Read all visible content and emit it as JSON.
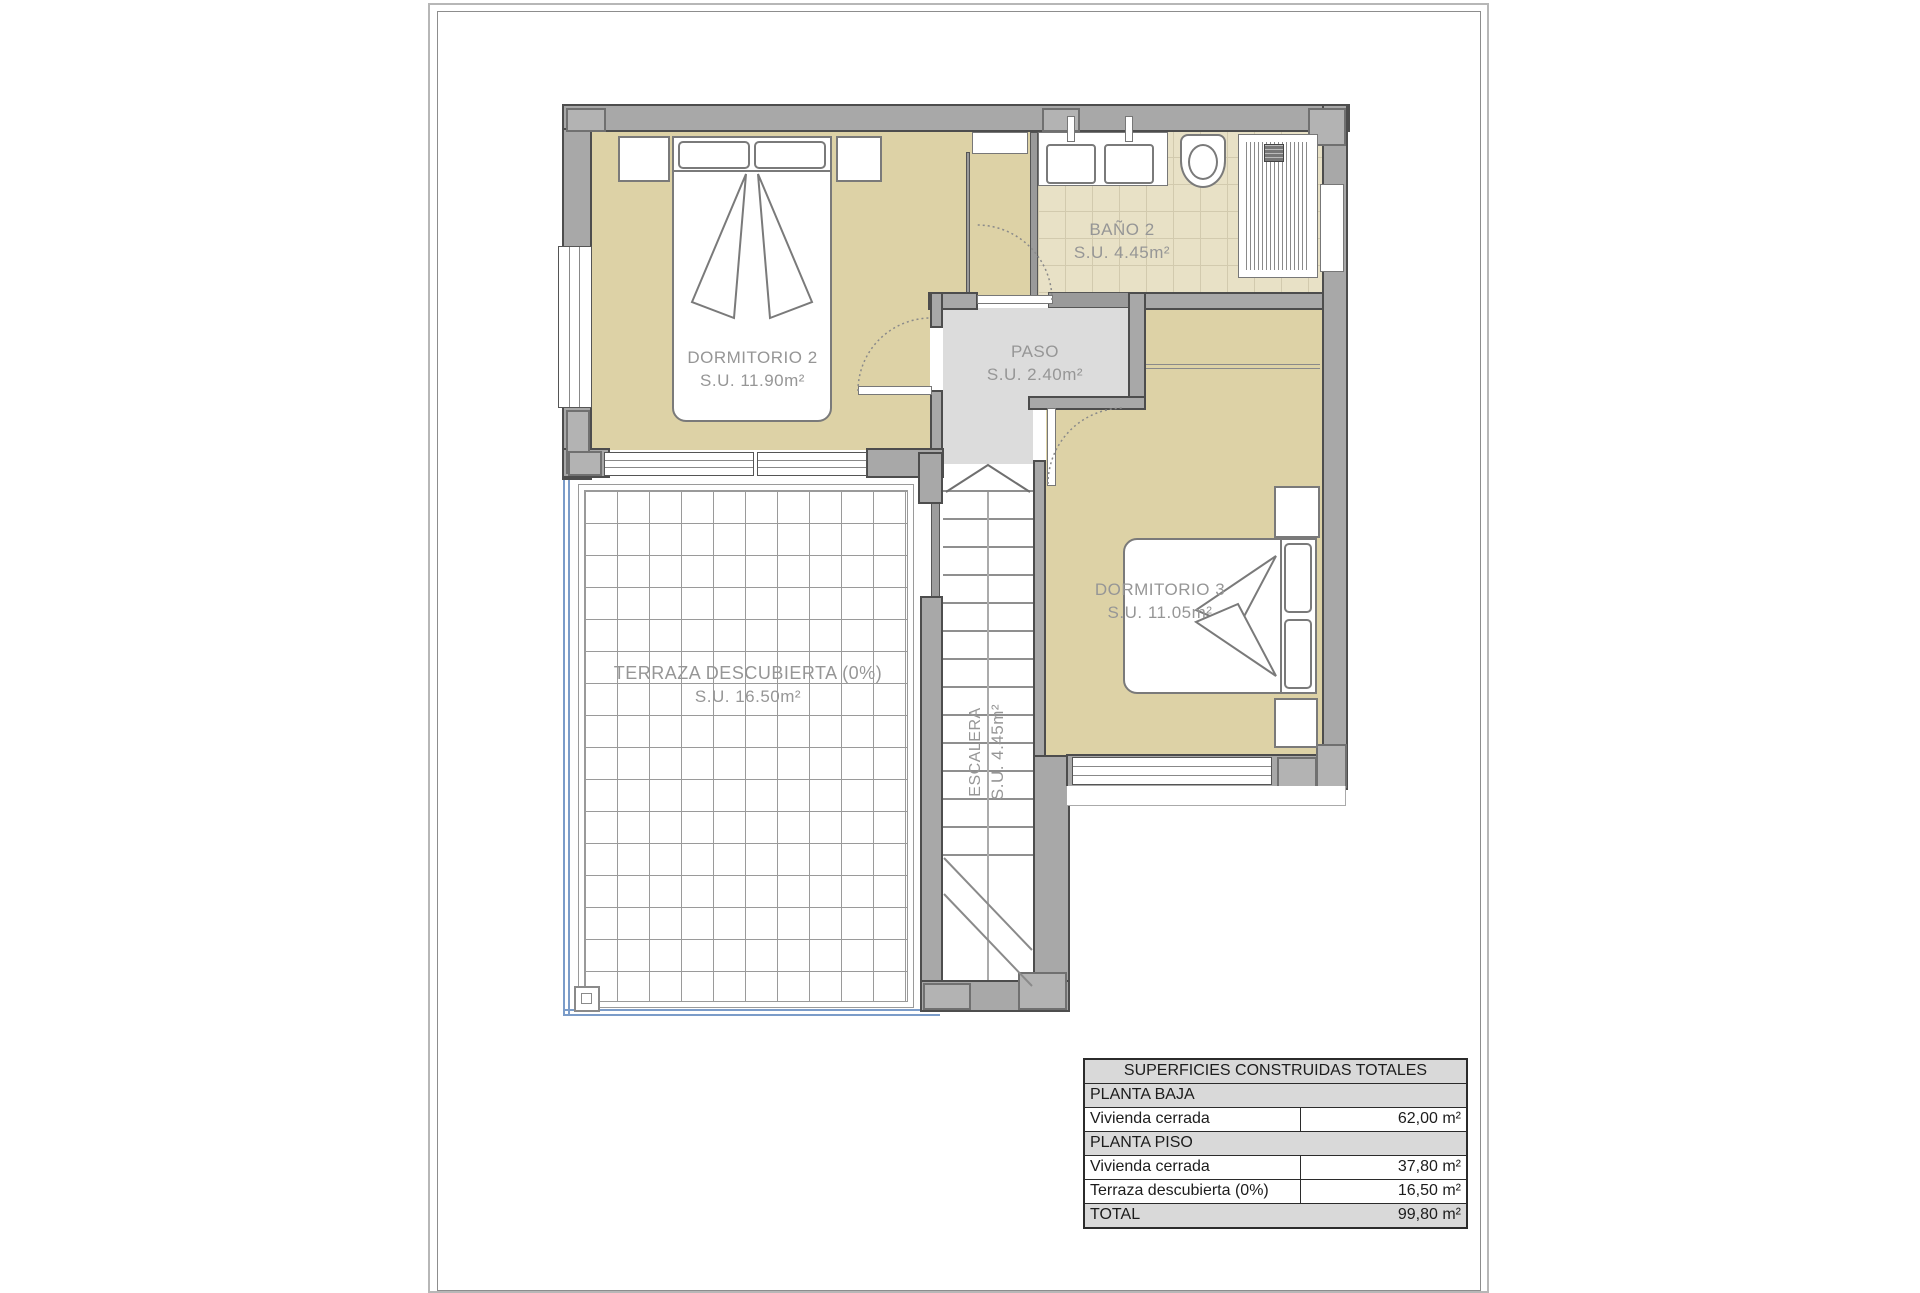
{
  "document": {
    "type": "floor-plan",
    "floor_name": "Planta piso"
  },
  "colors": {
    "room_fill": "#ddd2a6",
    "bath_tile": "#e8e1c6",
    "wall": "#a8a8a8",
    "wall_outline": "#4d4d4d",
    "paso_fill": "#dcdcdc",
    "terrace_rail_blue": "#7b9cc9",
    "label_text": "#969696",
    "table_header_bg": "#d9d9d9"
  },
  "rooms": {
    "dormitorio2": {
      "name": "DORMITORIO 2",
      "area": "S.U. 11.90m²"
    },
    "bano2": {
      "name": "BAÑO 2",
      "area": "S.U. 4.45m²"
    },
    "paso": {
      "name": "PASO",
      "area": "S.U. 2.40m²"
    },
    "dormitorio3": {
      "name": "DORMITORIO 3",
      "area": "S.U. 11.05m²"
    },
    "terraza": {
      "name": "TERRAZA DESCUBIERTA (0%)",
      "area": "S.U. 16.50m²"
    },
    "escalera": {
      "name": "ESCALERA",
      "area": "S.U. 4.45m²"
    }
  },
  "surfaces_table": {
    "title": "SUPERFICIES CONSTRUIDAS TOTALES",
    "rows": [
      {
        "label": "PLANTA BAJA",
        "value": ""
      },
      {
        "label": "Vivienda cerrada",
        "value": "62,00 m²"
      },
      {
        "label": "PLANTA PISO",
        "value": ""
      },
      {
        "label": "Vivienda cerrada",
        "value": "37,80 m²"
      },
      {
        "label": "Terraza descubierta (0%)",
        "value": "16,50 m²"
      },
      {
        "label": "TOTAL",
        "value": "99,80 m²"
      }
    ]
  }
}
